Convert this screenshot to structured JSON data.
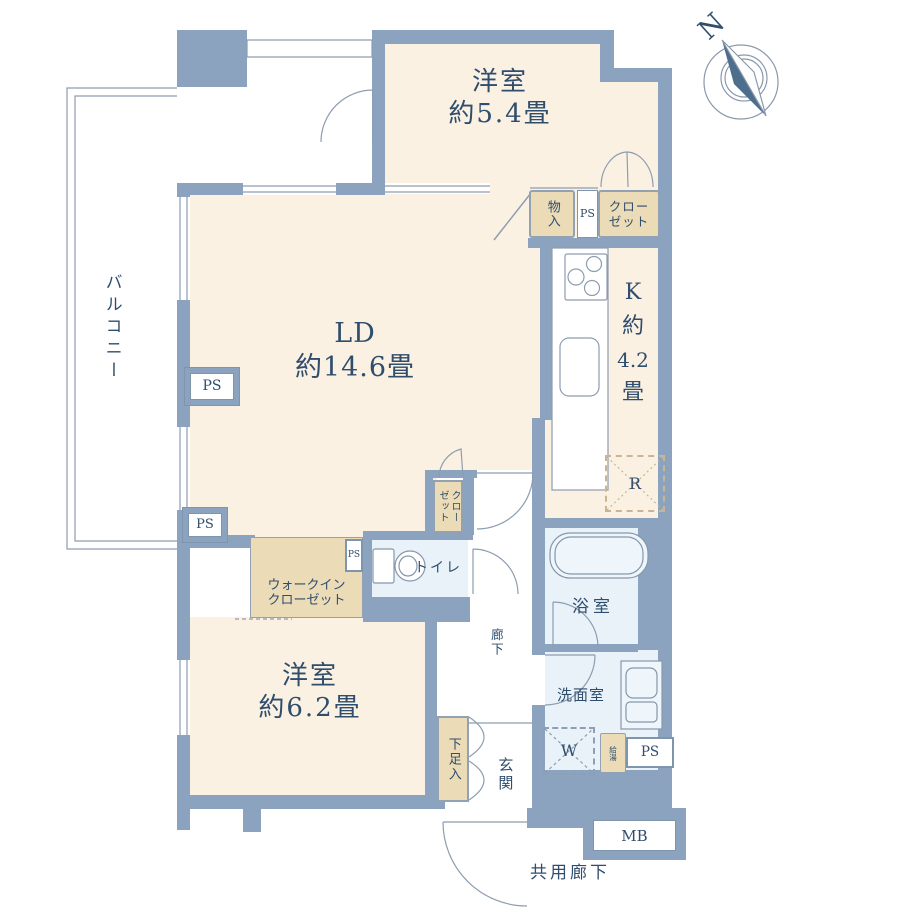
{
  "colors": {
    "wall": "#8ba3be",
    "room_cream": "#fbf1e2",
    "wet_blue": "#e9f2f9",
    "closet_tan": "#ebdbb7",
    "text_navy": "#2f4d6d",
    "thin_line": "#8d9db0",
    "compass_needle": "#4e6e8e"
  },
  "compass": {
    "north": "N"
  },
  "balcony": {
    "label": "バルコニー"
  },
  "rooms": {
    "bedroom_top": {
      "name": "洋室",
      "size": "約5.4畳"
    },
    "living_dining": {
      "name": "LD",
      "size": "約14.6畳"
    },
    "kitchen": {
      "l1": "K",
      "l2": "約",
      "l3": "4.2",
      "l4": "畳"
    },
    "bedroom_bottom": {
      "name": "洋室",
      "size": "約6.2畳"
    },
    "toilet": {
      "label": "トイレ"
    },
    "bath": {
      "label": "浴室"
    },
    "washroom": {
      "label": "洗面室"
    },
    "hallway": {
      "label": "廊下"
    },
    "entrance": {
      "label": "玄関"
    },
    "common_corridor": {
      "label": "共用廊下"
    }
  },
  "storage": {
    "monoire": {
      "label": "物入"
    },
    "closet_top": {
      "line1": "クロー",
      "line2": "ゼット"
    },
    "walk_in_closet": {
      "line1": "ウォークイン",
      "line2": "クローゼット"
    },
    "closet_small": {
      "label": "クローゼット"
    },
    "shoe_box": {
      "label": "下足入"
    }
  },
  "equipment": {
    "ps": "PS",
    "washer": "W",
    "fridge": "R",
    "water_heater": "給湯",
    "meter_box": "MB"
  }
}
